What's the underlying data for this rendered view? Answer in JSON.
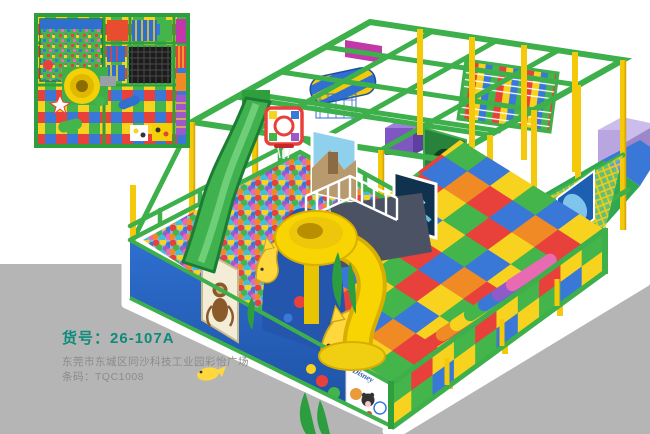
{
  "product": {
    "code_label": "货号：",
    "code": "26-107A",
    "address": "东莞市东城区同沙科技工业园彩怡广场",
    "barcode_label": "条码：",
    "barcode": "TQC1008"
  },
  "decor": {
    "disney_label": "Disney"
  },
  "colors": {
    "teal_text": "#0e8b7a",
    "gray_text": "#8b8b8b",
    "backdrop_gray": "#b5b5b6",
    "frame_green": "#3db04c",
    "post_yellow": "#f4c90a",
    "slide_yellow": "#f7d402",
    "wall_blue": "#2456ae",
    "mat_red": "#e8413c",
    "mat_yellow": "#f7d21e",
    "mat_green": "#43b54a",
    "mat_blue": "#3a78d8",
    "magenta": "#c238a8"
  }
}
